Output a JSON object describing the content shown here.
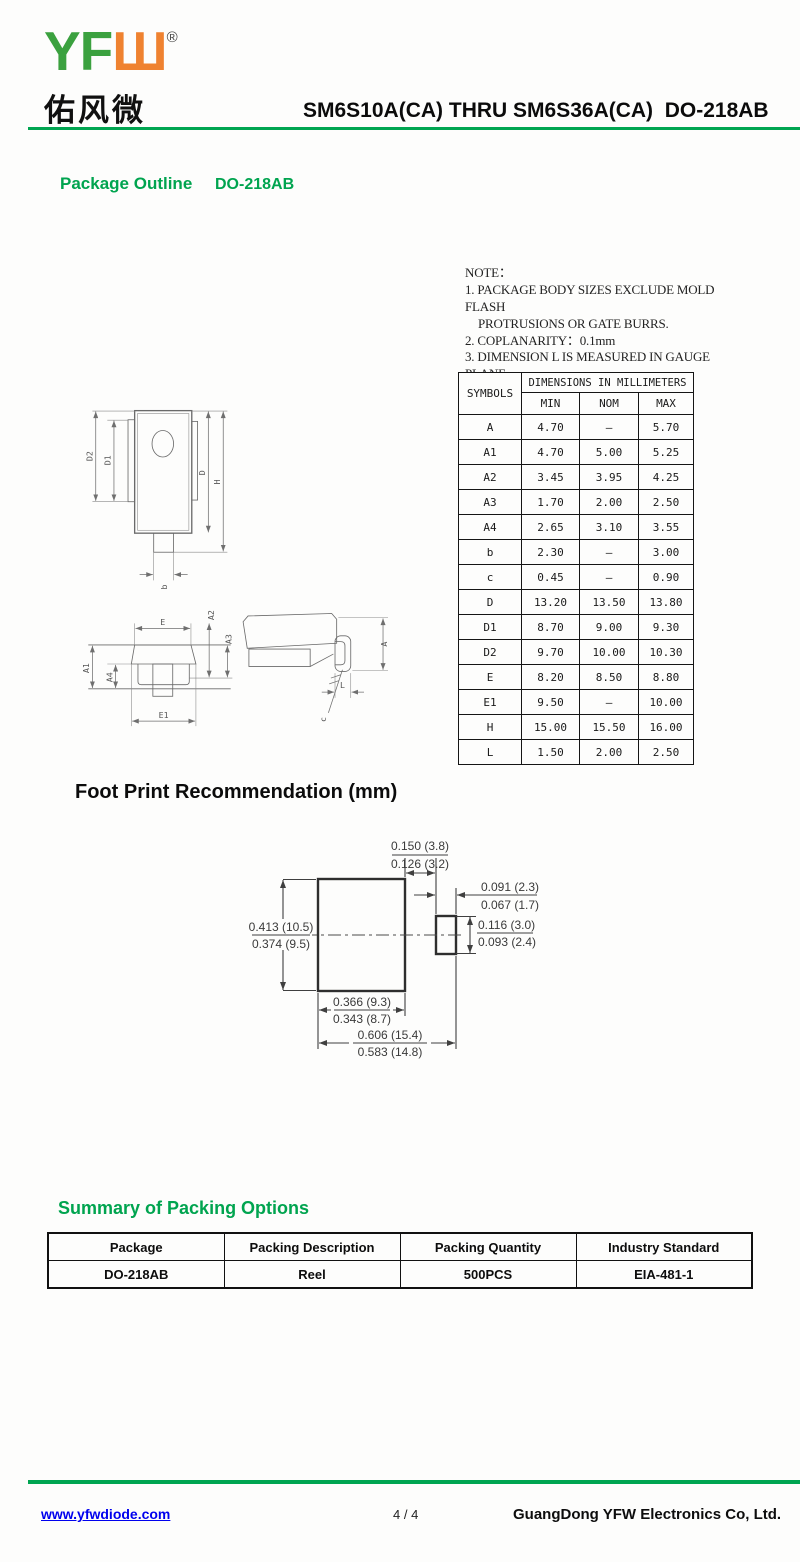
{
  "colors": {
    "accent_green": "#00A551",
    "logo_green": "#3BA13F",
    "logo_orange": "#EF8230",
    "link_blue": "#0000EE"
  },
  "header": {
    "logo_latin_green": "YF",
    "logo_latin_orange": "Ш",
    "registered_mark": "®",
    "logo_chinese": "佑风微",
    "title": "SM6S10A(CA) THRU SM6S36A(CA)  DO-218AB"
  },
  "package_outline": {
    "heading": "Package Outline",
    "package": "DO-218AB"
  },
  "notes": {
    "title": "NOTE：",
    "lines": [
      "1. PACKAGE BODY SIZES EXCLUDE MOLD FLASH",
      "PROTRUSIONS OR GATE BURRS.",
      "2. COPLANARITY：0.1mm",
      "3. DIMENSION L IS MEASURED IN GAUGE PLANE."
    ]
  },
  "dimensions_table": {
    "corner_header": "SYMBOLS",
    "group_header": "DIMENSIONS IN MILLIMETERS",
    "sub_headers": [
      "MIN",
      "NOM",
      "MAX"
    ],
    "rows": [
      [
        "A",
        "4.70",
        "–",
        "5.70"
      ],
      [
        "A1",
        "4.70",
        "5.00",
        "5.25"
      ],
      [
        "A2",
        "3.45",
        "3.95",
        "4.25"
      ],
      [
        "A3",
        "1.70",
        "2.00",
        "2.50"
      ],
      [
        "A4",
        "2.65",
        "3.10",
        "3.55"
      ],
      [
        "b",
        "2.30",
        "–",
        "3.00"
      ],
      [
        "c",
        "0.45",
        "–",
        "0.90"
      ],
      [
        "D",
        "13.20",
        "13.50",
        "13.80"
      ],
      [
        "D1",
        "8.70",
        "9.00",
        "9.30"
      ],
      [
        "D2",
        "9.70",
        "10.00",
        "10.30"
      ],
      [
        "E",
        "8.20",
        "8.50",
        "8.80"
      ],
      [
        "E1",
        "9.50",
        "–",
        "10.00"
      ],
      [
        "H",
        "15.00",
        "15.50",
        "16.00"
      ],
      [
        "L",
        "1.50",
        "2.00",
        "2.50"
      ]
    ]
  },
  "outline_drawing": {
    "labels": {
      "D2": "D2",
      "D1": "D1",
      "D": "D",
      "H": "H",
      "b": "b",
      "E": "E",
      "E1": "E1",
      "A1": "A1",
      "A4": "A4",
      "A2": "A2",
      "A3": "A3",
      "A": "A",
      "L": "L",
      "c": "c"
    }
  },
  "footprint": {
    "heading": "Foot Print Recommendation (mm)",
    "dim_gap_top": [
      "0.150 (3.8)",
      "0.126 (3.2)"
    ],
    "dim_pad2_width": [
      "0.091 (2.3)",
      "0.067 (1.7)"
    ],
    "dim_pad1_height": [
      "0.413 (10.5)",
      "0.374 (9.5)"
    ],
    "dim_pad2_height": [
      "0.116 (3.0)",
      "0.093 (2.4)"
    ],
    "dim_pad1_width": [
      "0.366 (9.3)",
      "0.343 (8.7)"
    ],
    "dim_overall": [
      "0.606 (15.4)",
      "0.583 (14.8)"
    ]
  },
  "packing": {
    "heading": "Summary of Packing Options",
    "columns": [
      "Package",
      "Packing Description",
      "Packing Quantity",
      "Industry Standard"
    ],
    "rows": [
      [
        "DO-218AB",
        "Reel",
        "500PCS",
        "EIA-481-1"
      ]
    ]
  },
  "footer": {
    "website": "www.yfwdiode.com",
    "page_indicator": "4 / 4",
    "company": "GuangDong YFW Electronics Co, Ltd."
  }
}
